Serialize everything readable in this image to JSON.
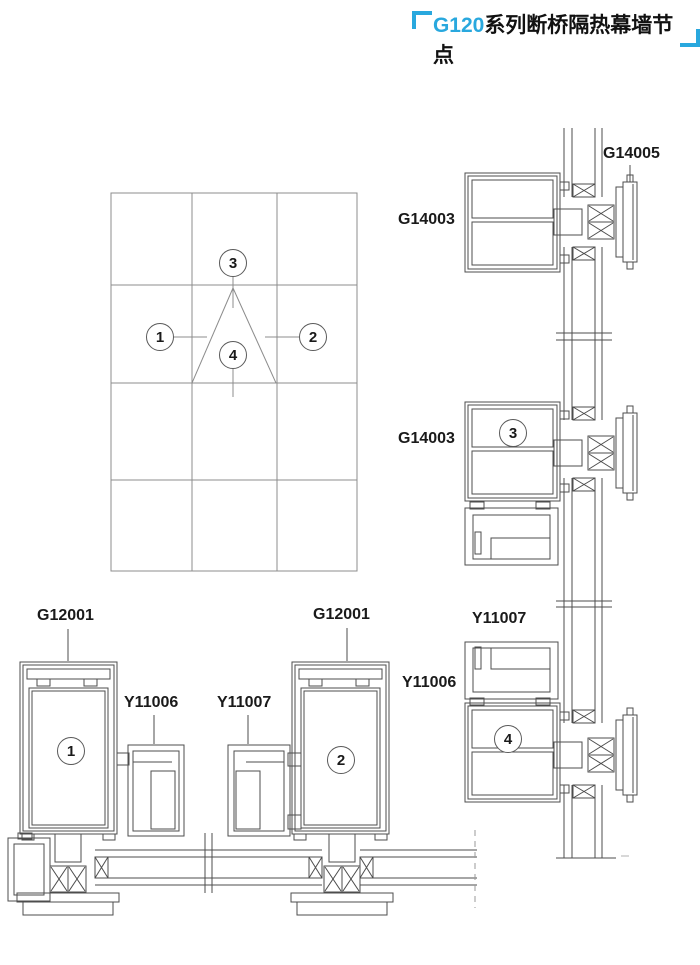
{
  "title": {
    "series": "G120",
    "rest": "系列断桥隔热幕墙节点"
  },
  "colors": {
    "accent": "#29a8de",
    "profile_line": "#4d4d4d",
    "grid_line": "#8c8c8c"
  },
  "labels": {
    "g14005": "G14005",
    "g14003_top": "G14003",
    "g14003_mid": "G14003",
    "y11007_right": "Y11007",
    "y11006_right": "Y11006",
    "g12001_left": "G12001",
    "y11006_left": "Y11006",
    "y11007_left": "Y11007",
    "g12001_mid": "G12001"
  },
  "callouts": {
    "c1": "1",
    "c2": "2",
    "c3": "3",
    "c4": "4"
  }
}
